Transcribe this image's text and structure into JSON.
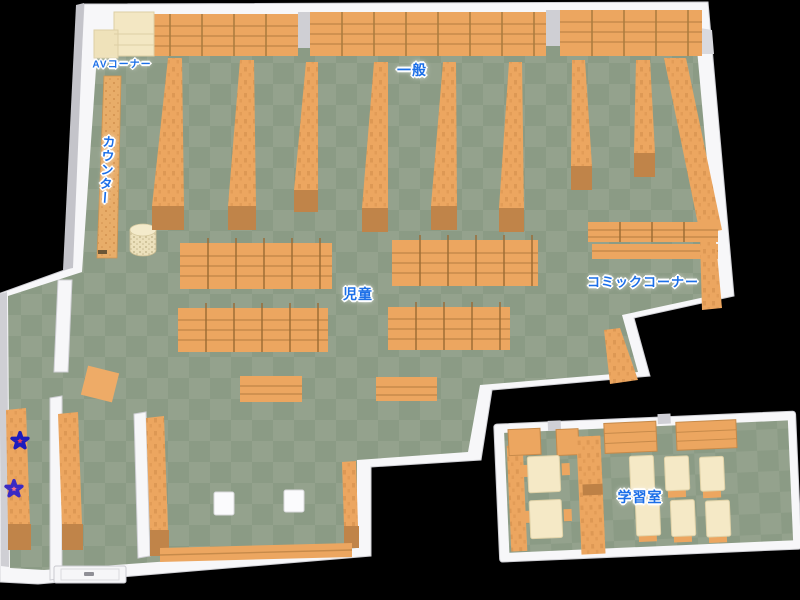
{
  "map": {
    "labels": {
      "av_corner": "AVコーナー",
      "general": "一般",
      "counter": "カウンター",
      "children": "児童",
      "comic_corner": "コミックコーナー",
      "study_room": "学習室"
    },
    "markers": [
      {
        "name": "star-upper",
        "color": "#e8435a",
        "outline": "#1c1cbe"
      },
      {
        "name": "star-lower",
        "color": "#f2738a",
        "outline": "#3a2ac4"
      }
    ],
    "colors": {
      "background": "#000000",
      "floor_light": "#94a28d",
      "floor_dark": "#8b9b85",
      "shelf": "#eca660",
      "shelf_dark": "#c08449",
      "wall": "#f7f7f9",
      "wall_shade": "#c4c4ca",
      "cream": "#f3e7c3",
      "label_text": "#1c6fe8",
      "label_halo": "#ffffff"
    }
  }
}
